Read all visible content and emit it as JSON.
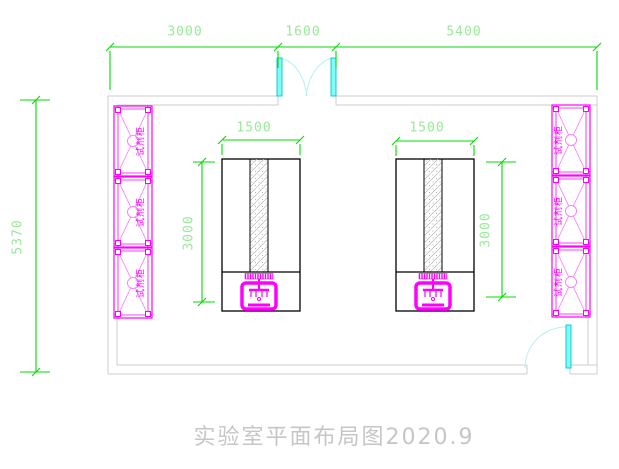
{
  "drawing": {
    "title": "实验室平面布局图2020.9"
  },
  "dimensions": {
    "top_left": "3000",
    "top_middle": "1600",
    "top_right": "5400",
    "left_height": "5370",
    "bench_left_width": "1500",
    "bench_right_width": "1500",
    "bench_left_depth": "3000",
    "bench_right_depth": "3000"
  },
  "cabinets": {
    "left": [
      "试剂柜",
      "试剂柜",
      "试剂柜"
    ],
    "right": [
      "试剂柜",
      "试剂柜",
      "试剂柜"
    ]
  },
  "colors": {
    "dimension_line": "#00dc00",
    "dimension_text": "#9ae89a",
    "wall": "#cccccc",
    "cabinet": "#ff00ff",
    "door_leaf": "#00e5e5",
    "door_arc": "#b8f0f0",
    "bench_outline": "#000000",
    "title_text": "#c6c6c6"
  }
}
